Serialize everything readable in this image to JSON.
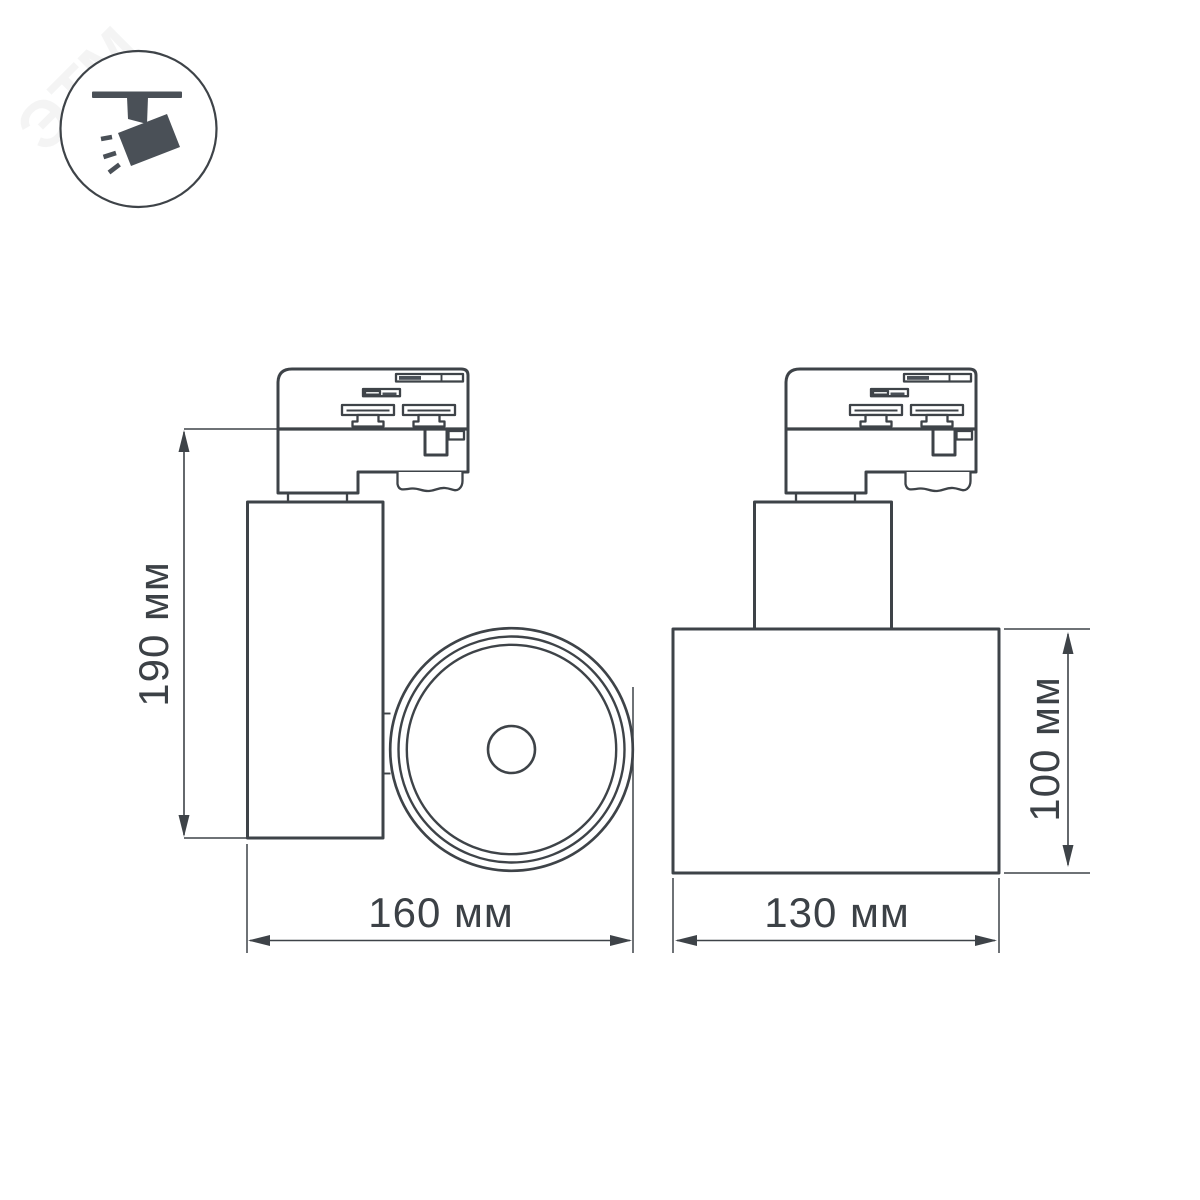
{
  "drawing": {
    "background": "#ffffff",
    "line_color": "#3e4348",
    "dark_fill": "#4a5057",
    "text_color": "#3c4146"
  },
  "badge": {
    "icon": "track-spotlight-icon"
  },
  "watermark": {
    "text": "ЭТМ"
  },
  "dimensions": {
    "side_height": {
      "label": "190 мм"
    },
    "side_width": {
      "label": "160 мм"
    },
    "front_height": {
      "label": "100 мм"
    },
    "front_width": {
      "label": "130 мм"
    }
  }
}
